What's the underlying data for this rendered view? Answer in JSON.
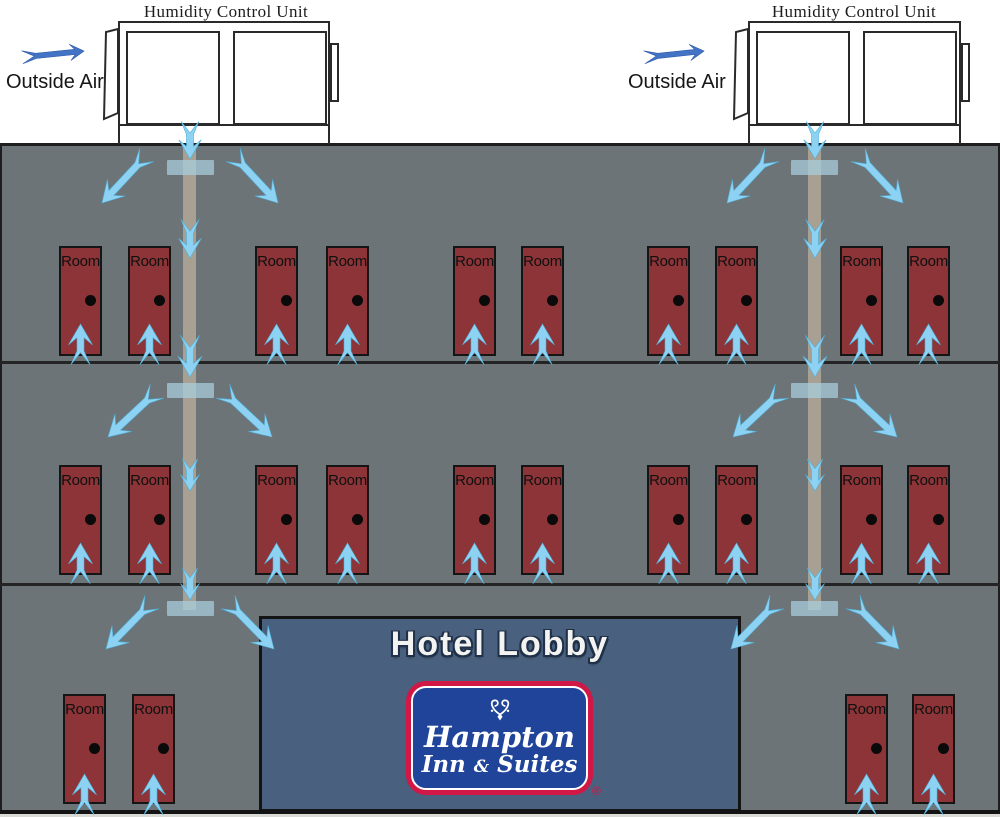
{
  "units": [
    {
      "title": "Humidity Control Unit",
      "outside_air_label": "Outside Air"
    },
    {
      "title": "Humidity Control Unit",
      "outside_air_label": "Outside Air"
    }
  ],
  "rooms": {
    "label": "Room",
    "doors_per_floor": [
      10,
      10,
      4
    ]
  },
  "lobby": {
    "title": "Hotel Lobby"
  },
  "logo": {
    "line1": "Hampton",
    "line2": "Inn",
    "amp": "&",
    "line3": "Suites",
    "registered": "®"
  },
  "colors": {
    "building_gray": "#6d7478",
    "line_dark": "#1e1e1e",
    "door_red": "#8c3437",
    "door_border": "#151515",
    "arrow_blue": "#8dd2f2",
    "arrow_edge": "#4fb0da",
    "outside_arrow_blue": "#4273c4",
    "lobby_blue": "#49617e",
    "logo_blue": "#1f4499",
    "logo_red": "#d01745"
  }
}
